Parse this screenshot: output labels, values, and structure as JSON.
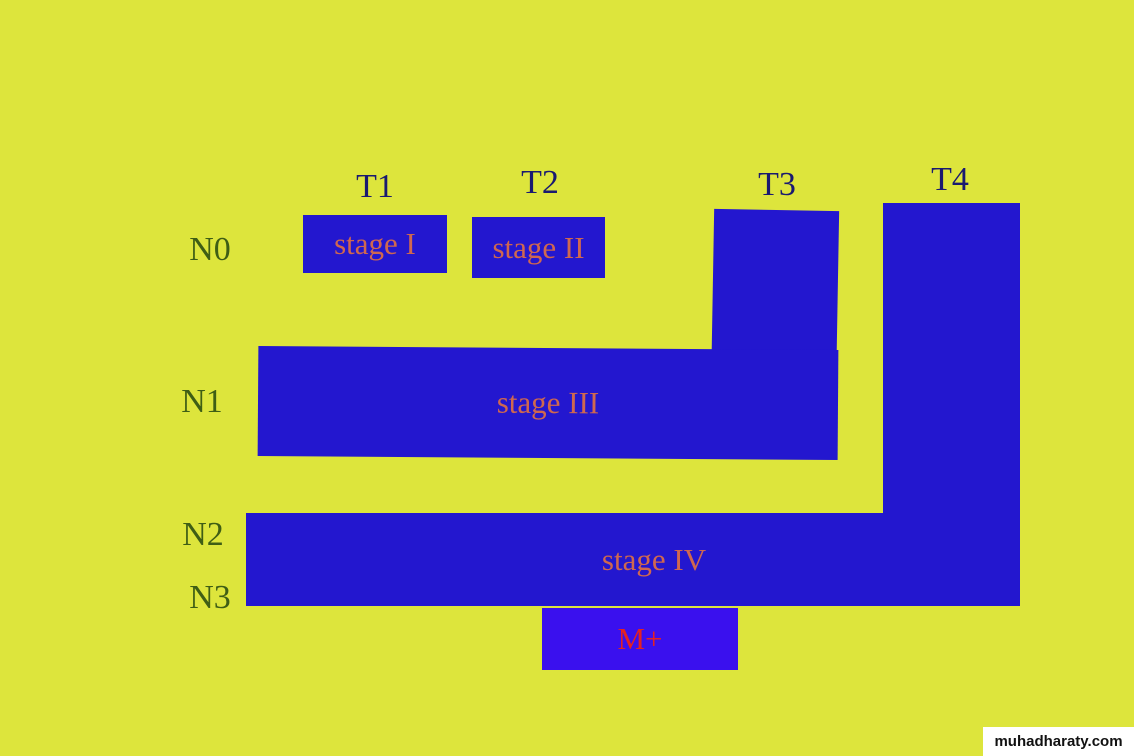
{
  "colors": {
    "background": "#dde53c",
    "bar_blue": "#2317cf",
    "m_box_blue": "#3a10ee",
    "stage_label_text": "#cf684f",
    "m_label_text": "#e32222",
    "t_label_text": "#1a1a70",
    "n_label_text": "#3f5e15",
    "watermark_bg": "#ffffff",
    "watermark_text_color": "#111111"
  },
  "t_labels": [
    "T1",
    "T2",
    "T3",
    "T4"
  ],
  "n_labels": [
    "N0",
    "N1",
    "N2",
    "N3"
  ],
  "stages": {
    "s1": "stage I",
    "s2": "stage II",
    "s3": "stage III",
    "s4": "stage IV",
    "m": "M+"
  },
  "watermark": "muhadharaty.com"
}
